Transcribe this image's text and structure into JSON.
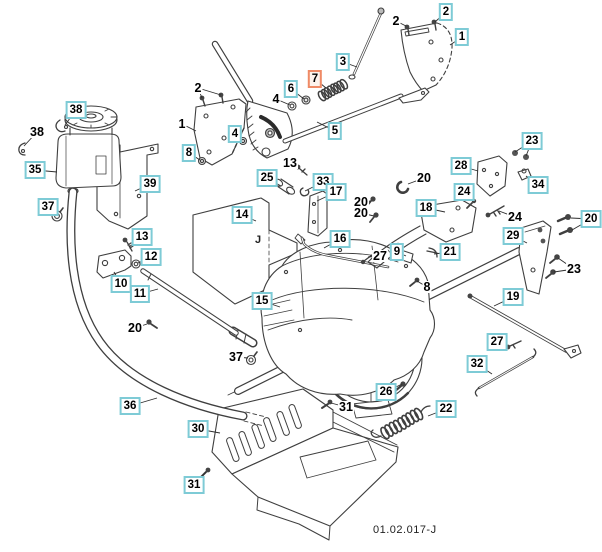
{
  "diagram": {
    "drawing_code": "01.02.017-J",
    "plate_marking": "J",
    "selected_part": "7",
    "colors": {
      "callout_box": "#7ecbd6",
      "callout_selected_box": "#ef8a66",
      "callout_selected_bg": "#fdf2ec",
      "line_art": "#3f3f3f",
      "leader": "#2e2e2e"
    },
    "callouts": [
      {
        "ref": "2",
        "style": "plain",
        "x": 198,
        "y": 88,
        "tx": 202,
        "ty": 98,
        "tx2": 221,
        "ty2": 95
      },
      {
        "ref": "1",
        "style": "plain",
        "x": 182,
        "y": 124,
        "tx": 196,
        "ty": 131
      },
      {
        "ref": "8",
        "style": "boxed",
        "x": 189,
        "y": 153,
        "tx": 200,
        "ty": 160
      },
      {
        "ref": "4",
        "style": "boxed",
        "x": 235,
        "y": 134,
        "tx": 242,
        "ty": 140
      },
      {
        "ref": "4",
        "style": "plain",
        "x": 276,
        "y": 99,
        "tx": 290,
        "ty": 105
      },
      {
        "ref": "6",
        "style": "boxed",
        "x": 291,
        "y": 89,
        "tx": 304,
        "ty": 99
      },
      {
        "ref": "2",
        "style": "plain",
        "x": 396,
        "y": 21,
        "tx": 406,
        "ty": 26
      },
      {
        "ref": "2",
        "style": "boxed",
        "x": 446,
        "y": 12,
        "tx": 435,
        "ty": 22
      },
      {
        "ref": "1",
        "style": "boxed",
        "x": 462,
        "y": 37,
        "tx": 450,
        "ty": 45
      },
      {
        "ref": "3",
        "style": "boxed",
        "x": 343,
        "y": 62,
        "tx": 357,
        "ty": 67
      },
      {
        "ref": "7",
        "style": "selected",
        "x": 315,
        "y": 79,
        "tx": 326,
        "ty": 88
      },
      {
        "ref": "5",
        "style": "boxed",
        "x": 335,
        "y": 131,
        "tx": 317,
        "ty": 122
      },
      {
        "ref": "38",
        "style": "boxed",
        "x": 76,
        "y": 110,
        "tx": 65,
        "ty": 125
      },
      {
        "ref": "38",
        "style": "plain",
        "x": 37,
        "y": 132,
        "tx": 24,
        "ty": 146
      },
      {
        "ref": "35",
        "style": "boxed",
        "x": 35,
        "y": 170,
        "tx": 57,
        "ty": 172
      },
      {
        "ref": "37",
        "style": "boxed",
        "x": 48,
        "y": 207,
        "tx": 58,
        "ty": 214
      },
      {
        "ref": "39",
        "style": "boxed",
        "x": 150,
        "y": 184,
        "tx": 135,
        "ty": 191
      },
      {
        "ref": "13",
        "style": "boxed",
        "x": 142,
        "y": 237,
        "tx": 129,
        "ty": 247
      },
      {
        "ref": "12",
        "style": "boxed",
        "x": 151,
        "y": 257,
        "tx": 138,
        "ty": 263
      },
      {
        "ref": "10",
        "style": "boxed",
        "x": 121,
        "y": 284,
        "tx": 114,
        "ty": 272
      },
      {
        "ref": "11",
        "style": "boxed",
        "x": 140,
        "y": 294,
        "tx": 158,
        "ty": 289
      },
      {
        "ref": "25",
        "style": "boxed",
        "x": 267,
        "y": 178,
        "tx": 281,
        "ty": 186
      },
      {
        "ref": "13",
        "style": "plain",
        "x": 290,
        "y": 163,
        "tx": 300,
        "ty": 169
      },
      {
        "ref": "33",
        "style": "boxed",
        "x": 323,
        "y": 182,
        "tx": 305,
        "ty": 191
      },
      {
        "ref": "17",
        "style": "boxed",
        "x": 336,
        "y": 192,
        "tx": 317,
        "ty": 201
      },
      {
        "ref": "14",
        "style": "boxed",
        "x": 242,
        "y": 215,
        "tx": 256,
        "ty": 221
      },
      {
        "ref": "16",
        "style": "boxed",
        "x": 340,
        "y": 239,
        "tx": 324,
        "ty": 248
      },
      {
        "ref": "20",
        "style": "plain",
        "x": 424,
        "y": 178,
        "tx": 408,
        "ty": 184
      },
      {
        "ref": "20",
        "style": "plain",
        "x": 361,
        "y": 202,
        "tx": 371,
        "ty": 201
      },
      {
        "ref": "20",
        "style": "plain",
        "x": 361,
        "y": 213,
        "tx": 374,
        "ty": 216
      },
      {
        "ref": "27",
        "style": "plain",
        "x": 380,
        "y": 256,
        "tx": 368,
        "ty": 257
      },
      {
        "ref": "9",
        "style": "boxed",
        "x": 397,
        "y": 252,
        "tx": 406,
        "ty": 256
      },
      {
        "ref": "21",
        "style": "boxed",
        "x": 450,
        "y": 252,
        "tx": 434,
        "ty": 254
      },
      {
        "ref": "18",
        "style": "boxed",
        "x": 426,
        "y": 208,
        "tx": 445,
        "ty": 212
      },
      {
        "ref": "24",
        "style": "boxed",
        "x": 464,
        "y": 192,
        "tx": 473,
        "ty": 200
      },
      {
        "ref": "24",
        "style": "plain",
        "x": 515,
        "y": 217,
        "tx": 499,
        "ty": 211
      },
      {
        "ref": "28",
        "style": "boxed",
        "x": 461,
        "y": 166,
        "tx": 478,
        "ty": 171
      },
      {
        "ref": "23",
        "style": "boxed",
        "x": 532,
        "y": 141,
        "tx": 515,
        "ty": 152,
        "tx2": 526,
        "ty2": 156
      },
      {
        "ref": "34",
        "style": "boxed",
        "x": 538,
        "y": 185,
        "tx": 526,
        "ty": 176
      },
      {
        "ref": "20",
        "style": "boxed",
        "x": 591,
        "y": 219,
        "tx": 571,
        "ty": 218,
        "tx2": 572,
        "ty2": 230
      },
      {
        "ref": "29",
        "style": "boxed",
        "x": 513,
        "y": 236,
        "tx": 527,
        "ty": 243
      },
      {
        "ref": "23",
        "style": "plain",
        "x": 574,
        "y": 269,
        "tx": 558,
        "ty": 258,
        "tx2": 554,
        "ty2": 272
      },
      {
        "ref": "19",
        "style": "boxed",
        "x": 513,
        "y": 297,
        "tx": 494,
        "ty": 306
      },
      {
        "ref": "8",
        "style": "plain",
        "x": 427,
        "y": 287,
        "tx": 417,
        "ty": 281
      },
      {
        "ref": "27",
        "style": "boxed",
        "x": 497,
        "y": 342,
        "tx": 508,
        "ty": 346
      },
      {
        "ref": "32",
        "style": "boxed",
        "x": 477,
        "y": 364,
        "tx": 492,
        "ty": 374
      },
      {
        "ref": "26",
        "style": "boxed",
        "x": 386,
        "y": 392,
        "tx": 402,
        "ty": 384
      },
      {
        "ref": "31",
        "style": "plain",
        "x": 346,
        "y": 407,
        "tx": 331,
        "ty": 403
      },
      {
        "ref": "22",
        "style": "boxed",
        "x": 446,
        "y": 409,
        "tx": 428,
        "ty": 416
      },
      {
        "ref": "15",
        "style": "boxed",
        "x": 262,
        "y": 301,
        "tx": 280,
        "ty": 307
      },
      {
        "ref": "20",
        "style": "plain",
        "x": 135,
        "y": 328,
        "tx": 147,
        "ty": 324
      },
      {
        "ref": "37",
        "style": "plain",
        "x": 236,
        "y": 357,
        "tx": 248,
        "ty": 358
      },
      {
        "ref": "36",
        "style": "boxed",
        "x": 130,
        "y": 406,
        "tx": 157,
        "ty": 398
      },
      {
        "ref": "30",
        "style": "boxed",
        "x": 198,
        "y": 429,
        "tx": 220,
        "ty": 433
      },
      {
        "ref": "31",
        "style": "boxed",
        "x": 194,
        "y": 485,
        "tx": 206,
        "ty": 472
      }
    ]
  }
}
